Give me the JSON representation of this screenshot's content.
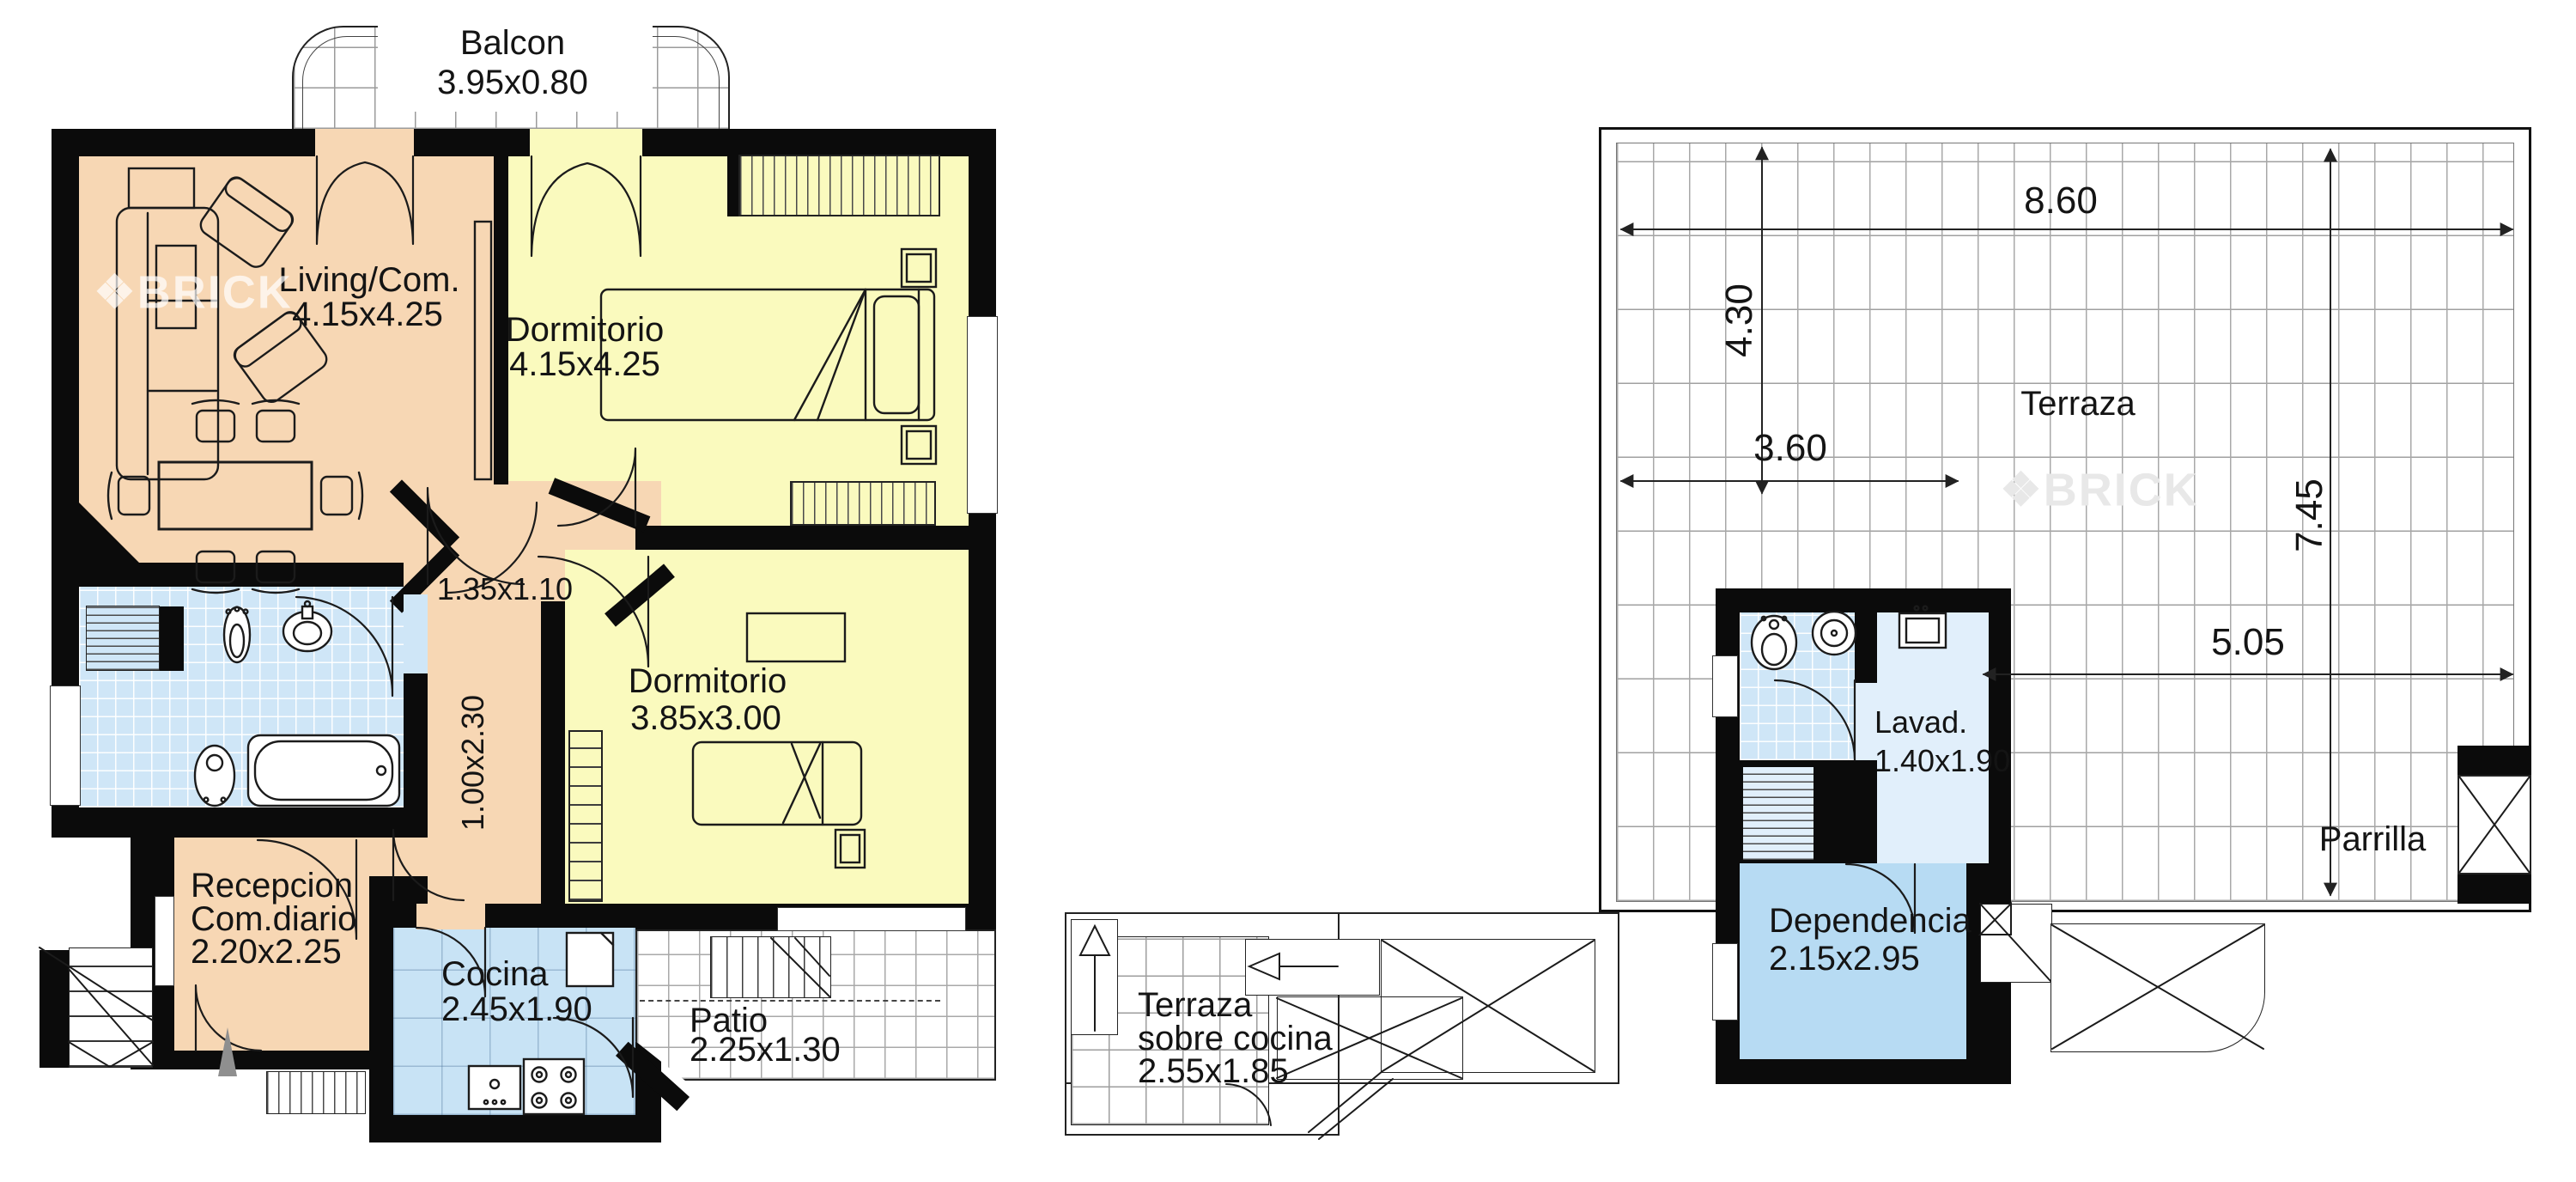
{
  "brand": {
    "watermark": "BRICK",
    "logo_glyph": "❖"
  },
  "colors": {
    "wall": "#0b0b0b",
    "living_peach": "#f7d7b4",
    "bedroom_yellow": "#fafabe",
    "wet_blue": "#cfe6f7",
    "kitchen_blue": "#c8e3f5",
    "dependency_blue": "#b7dbf3",
    "laundry_blue": "#e1effb",
    "line": "#1b1b1b"
  },
  "floor_plan": {
    "balcony": {
      "label": "Balcon",
      "dims": "3.95x0.80"
    },
    "living": {
      "label": "Living/Com.",
      "dims": "4.15x4.25"
    },
    "bedroom1": {
      "label": "Dormitorio",
      "dims": "4.15x4.25"
    },
    "hall": {
      "dims": "1.35x1.10"
    },
    "corridor": {
      "dims": "1.00x2.30"
    },
    "bedroom2": {
      "label": "Dormitorio",
      "dims": "3.85x3.00"
    },
    "reception": {
      "label_line1": "Recepcion",
      "label_line2": "Com.diario",
      "dims": "2.20x2.25"
    },
    "kitchen": {
      "label": "Cocina",
      "dims": "2.45x1.90"
    },
    "patio": {
      "label": "Patio",
      "dims": "2.25x1.30"
    }
  },
  "mezzanine_plan": {
    "terrace": {
      "label_line1": "Terraza",
      "label_line2": "sobre cocina",
      "dims": "2.55x1.85"
    }
  },
  "roof_plan": {
    "terrace": {
      "label": "Terraza"
    },
    "laundry": {
      "label": "Lavad.",
      "dims": "1.40x1.90"
    },
    "maid_room": {
      "label": "Dependencia",
      "dims": "2.15x2.95"
    },
    "grill": {
      "label": "Parrilla"
    },
    "dimensions": {
      "top_width": "8.60",
      "left_height": "4.30",
      "bottom_left_width": "3.60",
      "right_height": "7.45",
      "middle_width": "5.05"
    }
  }
}
